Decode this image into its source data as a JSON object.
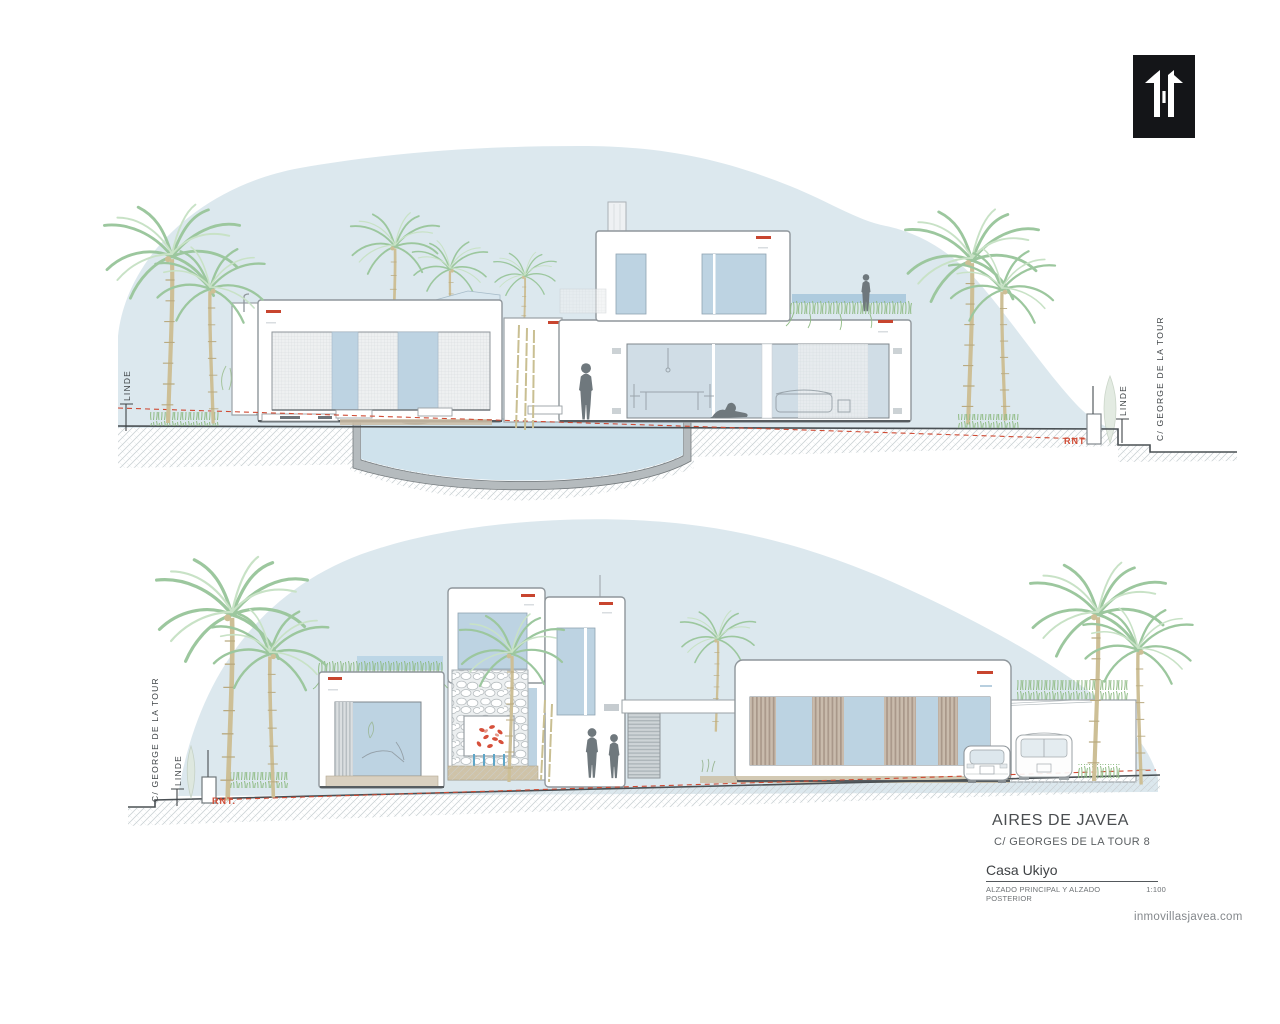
{
  "brand": {
    "logo_alt": "inmovillas monogram",
    "website": "inmovillasjavea.com"
  },
  "title_block": {
    "development": "AIRES DE JAVEA",
    "address": "C/ GEORGES DE LA TOUR 8",
    "project_name": "Casa Ukiyo",
    "sheet_title": "ALZADO PRINCIPAL Y ALZADO POSTERIOR",
    "scale": "1:100"
  },
  "upper_elevation": {
    "label_linde_left": "LINDE",
    "label_linde_right": "LINDE",
    "label_street_right": "C/ GEORGE DE LA TOUR",
    "label_rnt": "RNT"
  },
  "lower_elevation": {
    "label_street_left": "C/ GEORGE DE LA TOUR",
    "label_linde_left": "LINDE",
    "label_rnt": "RNT."
  },
  "colors": {
    "hill": "#dce8ee",
    "glass": "#bdd3e2",
    "accent_red": "#c8452f",
    "silhouette": "#6f787d",
    "pool_water": "#cfe2ec"
  }
}
